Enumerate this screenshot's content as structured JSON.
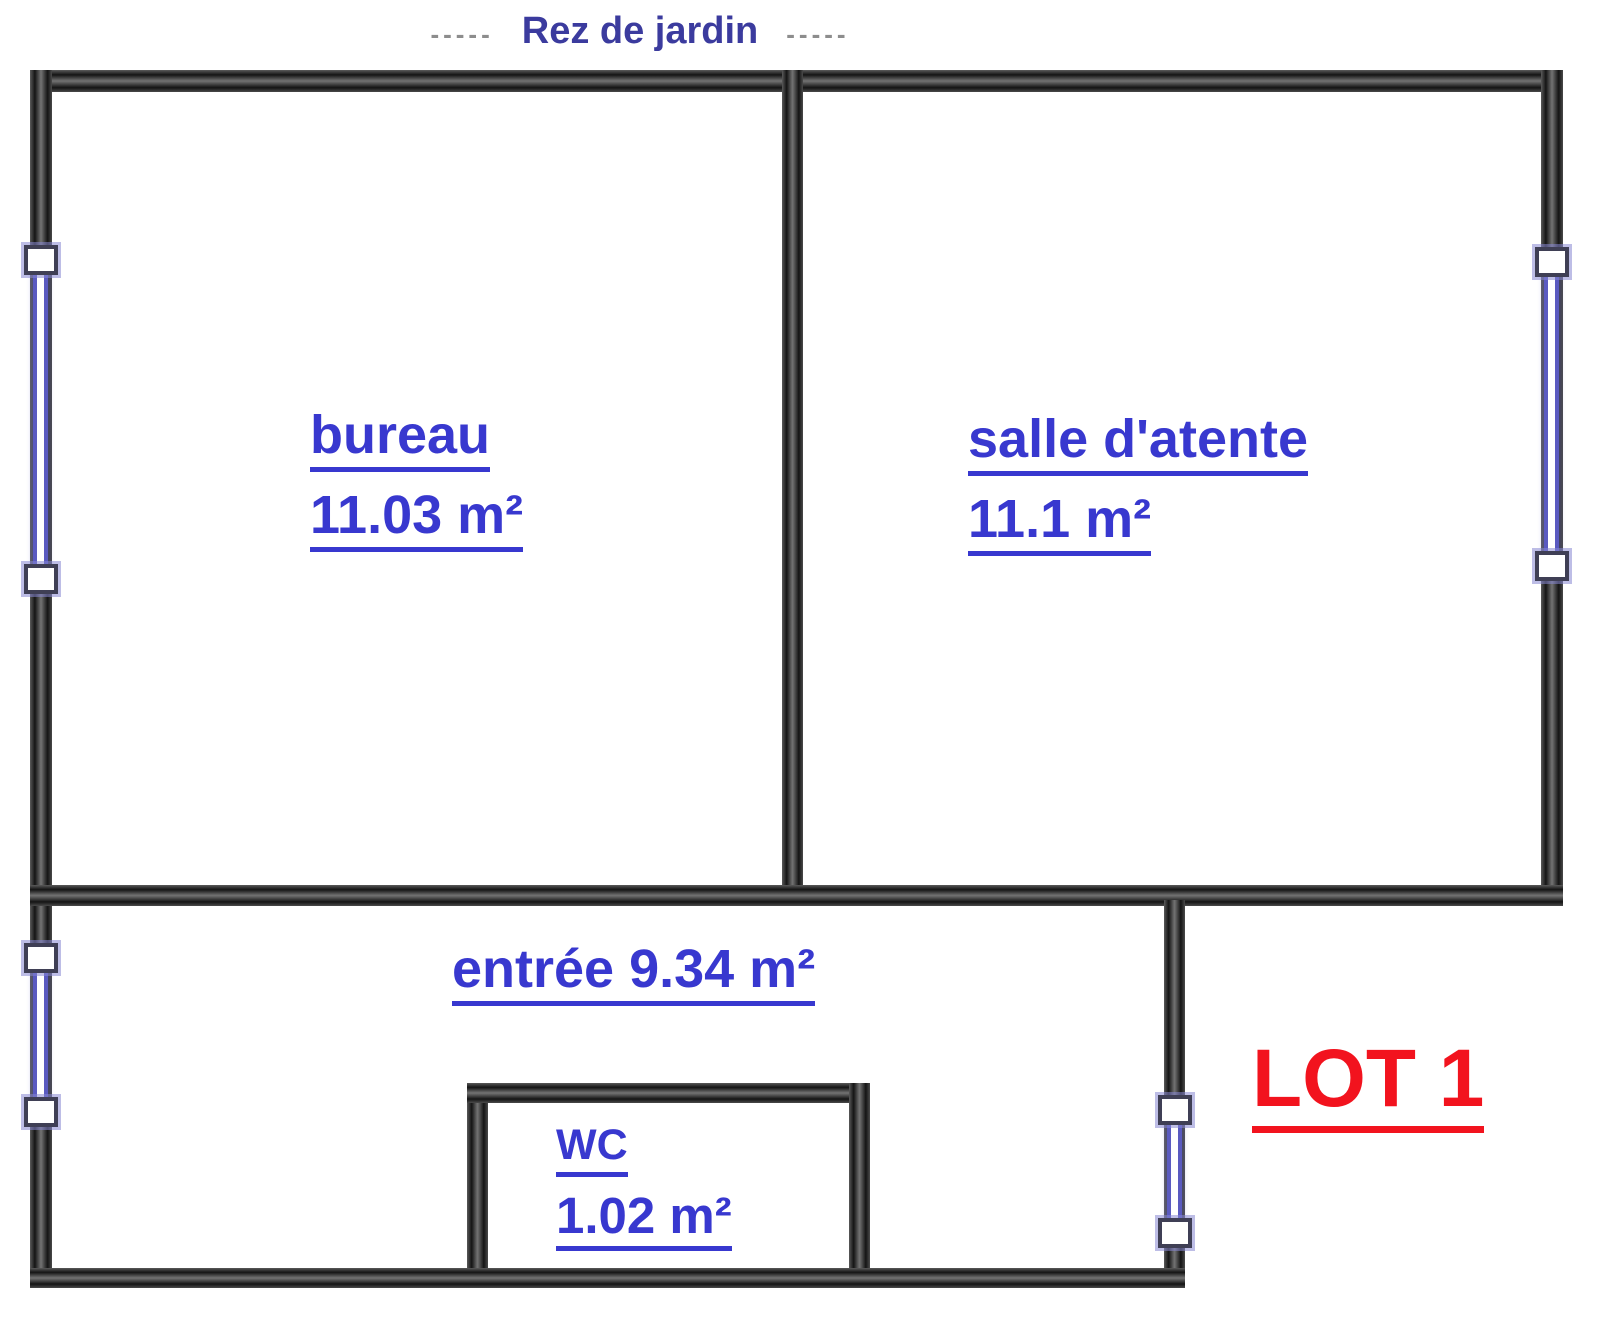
{
  "title": {
    "left_dashes": "-----",
    "text": "Rez de jardin",
    "right_dashes": "-----"
  },
  "rooms": {
    "bureau": {
      "name": "bureau",
      "area": "11.03 m²"
    },
    "salle_attente": {
      "name": "salle d'atente",
      "area": "11.1 m²"
    },
    "entree": {
      "label": "entrée 9.34 m²"
    },
    "wc": {
      "name": "WC",
      "area": "1.02 m²"
    }
  },
  "lot": {
    "label": "LOT 1"
  },
  "colors": {
    "room_label_blue": "#3838cf",
    "title_navy": "#3b3b9e",
    "dash_gray": "#8d8d8d",
    "lot_red": "#f2131e",
    "wall_dark": "#2a2a2a",
    "window_blue": "#5a5ac0"
  }
}
